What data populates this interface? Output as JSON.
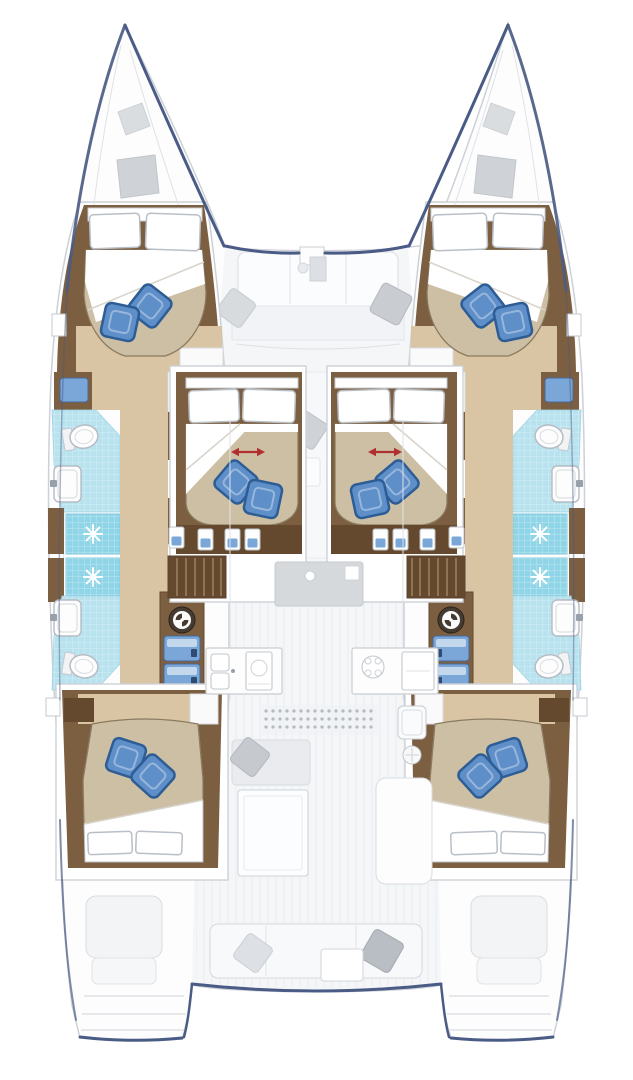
{
  "page": {
    "background": "#ffffff"
  },
  "diagram": {
    "type": "yacht-deck-plan",
    "subject": "sailing catamaran interior layout, top-down view",
    "orientation": "bow at top, stern at bottom",
    "hulls": [
      "port",
      "starboard"
    ],
    "cabins": [
      {
        "id": "forward-port-cabin",
        "berth": "double",
        "white_pillows": 2,
        "blue_cushions": 2
      },
      {
        "id": "forward-starboard-cabin",
        "berth": "double",
        "white_pillows": 2,
        "blue_cushions": 2
      },
      {
        "id": "mid-port-cabin",
        "berth": "double with sliding mark (red double arrow)",
        "white_pillows": 2,
        "blue_cushions": 2
      },
      {
        "id": "mid-starboard-cabin",
        "berth": "double with sliding mark (red double arrow)",
        "white_pillows": 2,
        "blue_cushions": 2
      },
      {
        "id": "aft-port-cabin",
        "berth": "double",
        "white_pillows": 2,
        "blue_cushions": 2
      },
      {
        "id": "aft-starboard-cabin",
        "berth": "double",
        "white_pillows": 2,
        "blue_cushions": 2
      }
    ],
    "bathrooms": [
      {
        "id": "port-forward-head",
        "fixtures": [
          "toilet",
          "sink",
          "shower-stall"
        ]
      },
      {
        "id": "port-aft-head",
        "fixtures": [
          "toilet",
          "sink",
          "shower-stall"
        ]
      },
      {
        "id": "starboard-forward-head",
        "fixtures": [
          "toilet",
          "sink",
          "shower-stall"
        ]
      },
      {
        "id": "starboard-aft-head",
        "fixtures": [
          "toilet",
          "sink",
          "shower-stall"
        ]
      }
    ],
    "equipment": {
      "washing_machines": 2,
      "blue_front_drawer_units": 4,
      "companionway_stairs": 2,
      "galley": [
        "double-sink",
        "oven",
        "four-burner-stove",
        "fridge-unit"
      ],
      "deck_hatches": 4
    },
    "deck_areas": {
      "foredeck": [
        "forward bench seat",
        "2 gray scatter cushions",
        "anchor locker fitting"
      ],
      "salon": [
        "front sofa island",
        "port galley counter",
        "starboard galley counter",
        "dotted sliding-door track"
      ],
      "center-walkway": [
        "gray scatter cushion",
        "seat cube"
      ],
      "cockpit": [
        "port sofa with gray cushion",
        "dining table",
        "starboard lounge",
        "wet-bar module"
      ],
      "aft": [
        "aft bench with 2 gray cushions",
        "small table",
        "port transom steps",
        "starboard transom steps",
        "2 helm/step seats"
      ]
    }
  },
  "colors": {
    "wood": "#7c5e41",
    "wood_dark": "#64492f",
    "floor_tan": "#d9c4a3",
    "bed_beige": "#cdbfa4",
    "sheet_white": "#ffffff",
    "cushion_blue": "#5f8fc9",
    "cushion_blue_dark": "#2e5d95",
    "tile_cyan": "#b7e2ee",
    "shower_cyan": "#8fd5e7",
    "hull_accent": "#4a5c85",
    "line_gray": "#ccd1d7",
    "line_faint": "#dfe2e6",
    "deck_gray": "#f3f5f7",
    "furn_gray": "#d6d9dc",
    "pillow_gray": "#ccd0d5",
    "arrow_red": "#b03030",
    "drawer_blue": "#7aa6d8"
  }
}
